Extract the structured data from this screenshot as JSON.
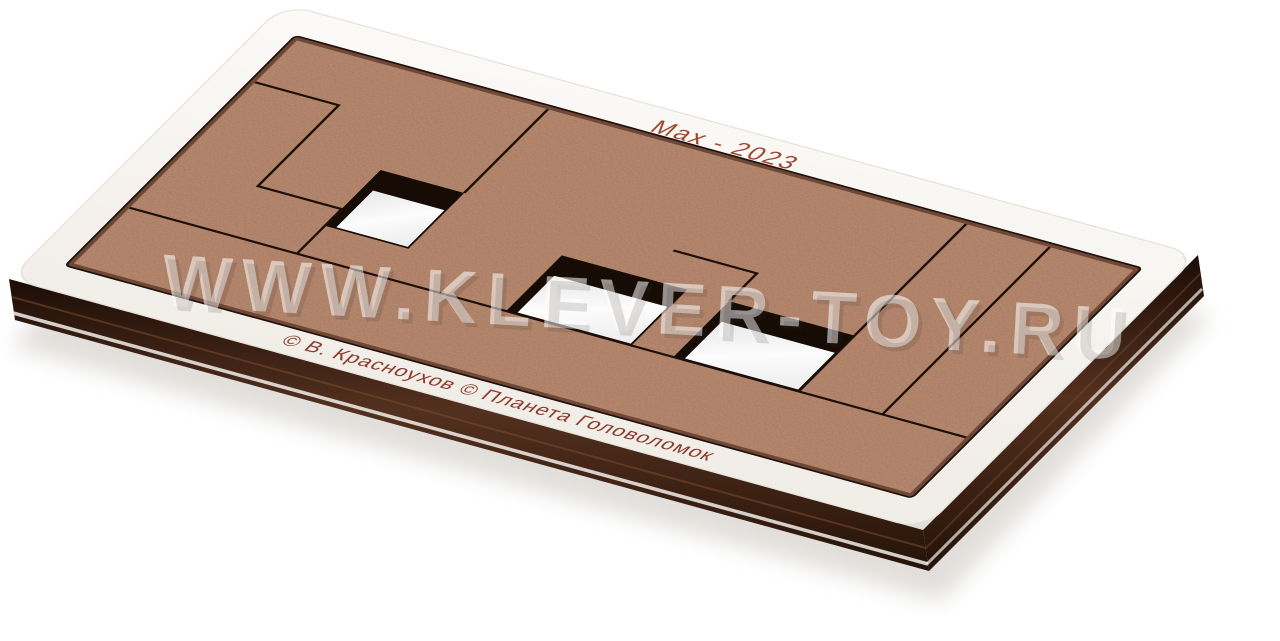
{
  "photo": {
    "description": "Product photo of a flat wooden tray puzzle made of white-faced plywood with brown MDF pieces, shot in perspective on a white background",
    "watermark_text": "WWW.KLEVER-TOY.RU",
    "engravings": {
      "title": "Max - 2023",
      "credits": "© В. Красноухов   © Планета Головоломок"
    },
    "colors": {
      "background": "#ffffff",
      "tray_face": "#f8f6f2",
      "tray_face_edge": "#e7e2da",
      "mdf_piece": "#bc8d73",
      "mdf_speck": "#4a2c1c",
      "recess_wall": "#6e4736",
      "cut_line": "#1d0f08",
      "side_dark": "#2a150c",
      "side_mid": "#53301f",
      "side_seam": "#7a4a2e",
      "bottom_sheet_edge": "#f2efea",
      "hole_floor": "#fcfcfc",
      "hole_shadow": "#160b05",
      "engraving_title": "#a0462f",
      "engraving_credits": "#8a3b2e",
      "shadow": "#c9c4bd"
    },
    "board": {
      "grid": {
        "cols": 10,
        "rows": 4
      },
      "holes": [
        {
          "x": 2,
          "y": 1.5,
          "w": 1,
          "h": 1
        },
        {
          "x": 4.5,
          "y": 2,
          "w": 1.5,
          "h": 1
        },
        {
          "x": 6.5,
          "y": 2,
          "w": 1.5,
          "h": 1
        }
      ],
      "cuts": [
        [
          [
            0,
            0.75
          ],
          [
            1,
            0.75
          ],
          [
            1,
            2.2
          ],
          [
            2,
            2.2
          ],
          [
            2,
            3
          ]
        ],
        [
          [
            3,
            0
          ],
          [
            3,
            1.5
          ]
        ],
        [
          [
            5.5,
            1.5
          ],
          [
            6.5,
            1.5
          ],
          [
            6.5,
            2
          ]
        ],
        [
          [
            8,
            0
          ],
          [
            8,
            3
          ]
        ],
        [
          [
            9,
            0
          ],
          [
            9,
            3
          ]
        ],
        [
          [
            0,
            3
          ],
          [
            10,
            3
          ]
        ]
      ]
    }
  }
}
